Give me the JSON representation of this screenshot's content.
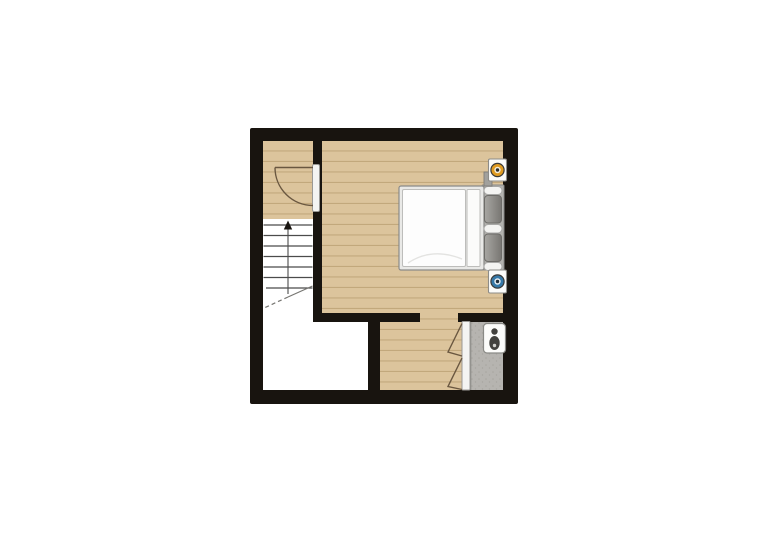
{
  "page": {
    "background": "#ffffff",
    "title": "floor-plan-image"
  },
  "floor_plan": {
    "kind": "residential upper-floor plan, top-down view, no text labels",
    "colors": {
      "wall": "#18140f",
      "wood_floor": "#dcc49c",
      "wood_plank_line": "#c2a87c",
      "bathroom_floor": "#b6b4b0",
      "bathroom_speckle": "#a7a5a0",
      "bathroom_floor_edge": "#8c8a86",
      "white_floor": "#ffffff",
      "stair_line": "#4b4b4b",
      "stair_cut": "#777672",
      "door_line": "#6a5740",
      "threshold_fill": "#f4f4f2",
      "threshold_stroke": "#9a9995",
      "fixture_frame": "#fcfcfa",
      "fixture_stroke": "#8d8c88",
      "bed_frame": "#e9e9e7",
      "duvet": "#fdfdfd",
      "headboard": "#b3b2ae",
      "pillow_light": "#a8a7a3",
      "pillow_dark": "#787672",
      "toilet_dark": "#43423e",
      "accent_orange": "#e09b20",
      "accent_blue": "#3679a8",
      "accent_rim": "#3a3a38"
    },
    "objects": [
      "exterior-wall",
      "landing-wood-floor",
      "bedroom-wood-floor",
      "hallway-wood-floor",
      "storage-room-white-floor",
      "staircase-with-up-arrow",
      "hinged-door-with-swing-arc",
      "double-bed-with-pillows",
      "orange-wall-fixture",
      "blue-wall-fixture",
      "bifold-door",
      "bathroom-gray-floor",
      "toilet"
    ]
  }
}
